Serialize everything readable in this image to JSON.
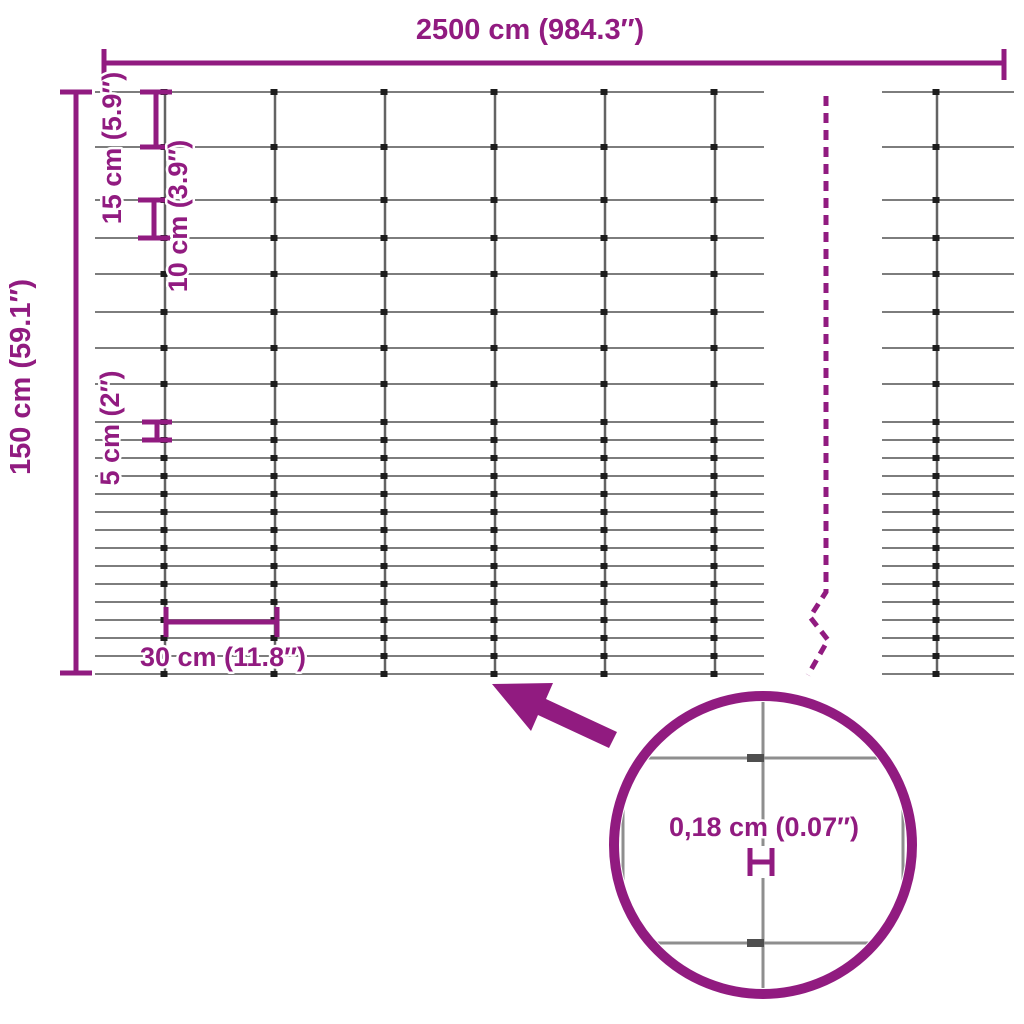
{
  "colors": {
    "accent": "#911b80",
    "wire_horizontal": "#7d7d7d",
    "wire_vertical": "#636363",
    "knot": "#1c1c1c",
    "zoom_wire": "#8e8e8e",
    "zoom_knot": "#4f4f4f",
    "background": "#ffffff"
  },
  "labels": {
    "width": "2500 cm (984.3″)",
    "height": "150 cm (59.1″)",
    "spacing_15": "15 cm (5.9″)",
    "spacing_10": "10 cm (3.9″)",
    "spacing_5": "5 cm (2″)",
    "cell_width": "30 cm (11.8″)",
    "wire_thickness": "0,18 cm (0.07″)"
  },
  "dimensions": {
    "width_cm": 2500,
    "width_in": 984.3,
    "height_cm": 150,
    "height_in": 59.1,
    "top_row_spacing_cm": 15,
    "middle_row_spacing_cm": 10,
    "bottom_row_spacing_cm": 5,
    "cell_width_cm": 30,
    "wire_thickness_cm": 0.18,
    "wire_thickness_in": 0.07
  }
}
